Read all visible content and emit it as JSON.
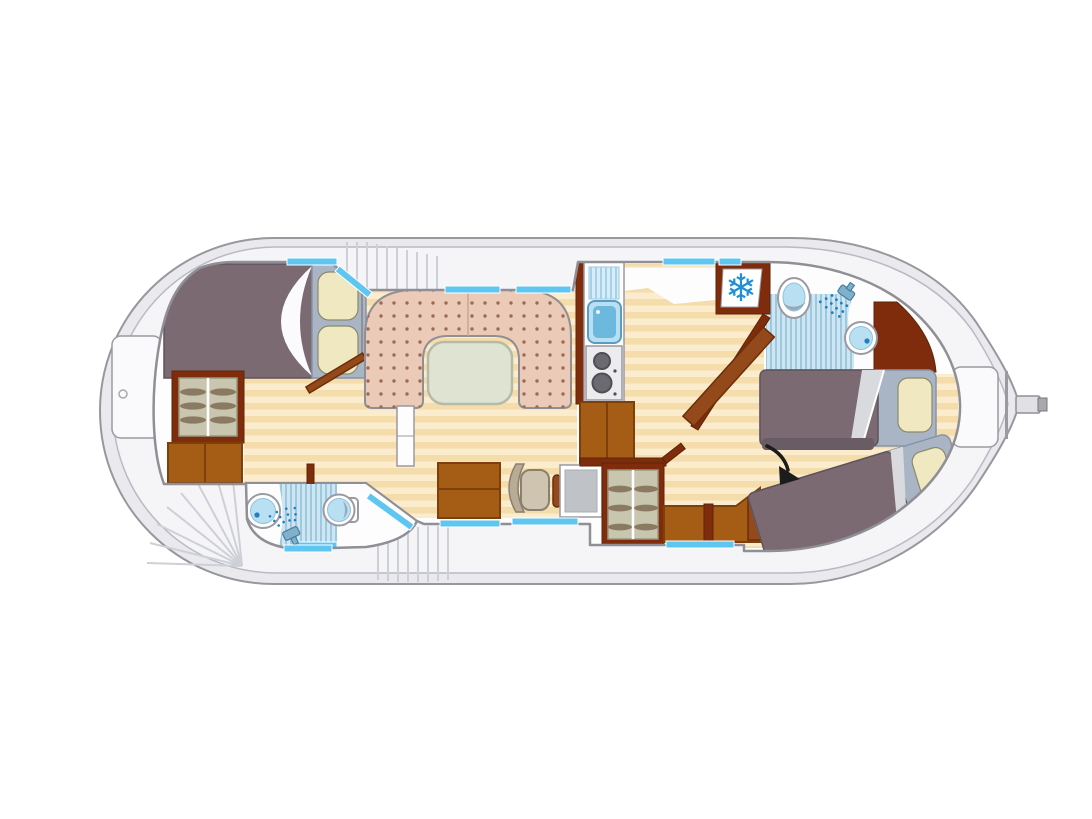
{
  "diagram": {
    "kind": "houseboat-floor-plan",
    "view": "top-down",
    "orientation": "bow-right-stern-left"
  },
  "icons": {
    "snowflake": "❄",
    "shower": "shower-head-with-spray",
    "direction_arrow": "curved-black-arrow"
  },
  "elements": [
    "stern-deck",
    "stern-hatch",
    "stern-stairs",
    "side-steps",
    "aft-cabin",
    "aft-double-bed",
    "aft-wardrobe",
    "aft-cabinet",
    "aft-cabin-door",
    "aft-bathroom",
    "aft-bathroom-sink",
    "aft-bathroom-toilet",
    "aft-bathroom-shower",
    "salon",
    "dinette-sofa",
    "dinette-table",
    "salon-cabinet",
    "helm-bench",
    "helm-seat",
    "steering-wheel",
    "helm-console",
    "helm-wardrobe",
    "galley",
    "galley-drainboard",
    "galley-sink",
    "galley-stove",
    "galley-cabinet",
    "fridge",
    "fwd-bathroom",
    "fwd-bathroom-sink",
    "fwd-bathroom-toilet",
    "fwd-bathroom-shower",
    "bow-cabin",
    "bow-bed-upper",
    "bow-bed-lower",
    "bow-bench",
    "bow-hatch",
    "bowsprit",
    "windows"
  ],
  "colors": {
    "hull_band": "#e9e9ee",
    "hull_stroke": "#97979d",
    "deck": "#f5f5f8",
    "deck_edge": "#babac2",
    "deck_line": "#cdd0d6",
    "hatch": "#fafafc",
    "room": "#fdfdfe",
    "wall": "#8f8f95",
    "floor_a": "#f4dcab",
    "floor_b": "#fbeccd",
    "window": "#5ec6f0",
    "sofa": "#eccab8",
    "sofa_dot": "#9c6b55",
    "table": "#dfe3d2",
    "table_edge": "#b6baa8",
    "blanket": "#7c6a72",
    "blanket_edge": "#5f5359",
    "mattress": "#a9b5c5",
    "mattress_edge": "#8794a6",
    "pillow": "#efe8c1",
    "pillow_edge": "#8a8a6a",
    "sheet": "#fbfbfd",
    "wood": "#a55d15",
    "wood_dark": "#7d3f0c",
    "wall_brown": "#7e2c0c",
    "door_brown": "#93491a",
    "wardrobe_in": "#c9c6b0",
    "hanger": "#8a7a62",
    "water_pale": "#d8edf8",
    "water_stripe": "#a5d2e8",
    "water": "#b8dff2",
    "water_deep": "#6db8dd",
    "water_dot": "#1f7fc0",
    "ring": "#9a9aa0",
    "fixture_shadow": "#8a8a92",
    "shower_zone": "#cfe6f2",
    "shower_stripe": "#9cc8e0",
    "seat": "#cfc4b0",
    "seat_back": "#b9ac96",
    "seat_edge": "#8a8070",
    "console": "#bfc2c6",
    "steel": "#ececee",
    "burner": "#6a6a70",
    "burner_edge": "#4e4e54",
    "snowflake": "#1e90d6",
    "arrow": "#1c1c1c"
  }
}
